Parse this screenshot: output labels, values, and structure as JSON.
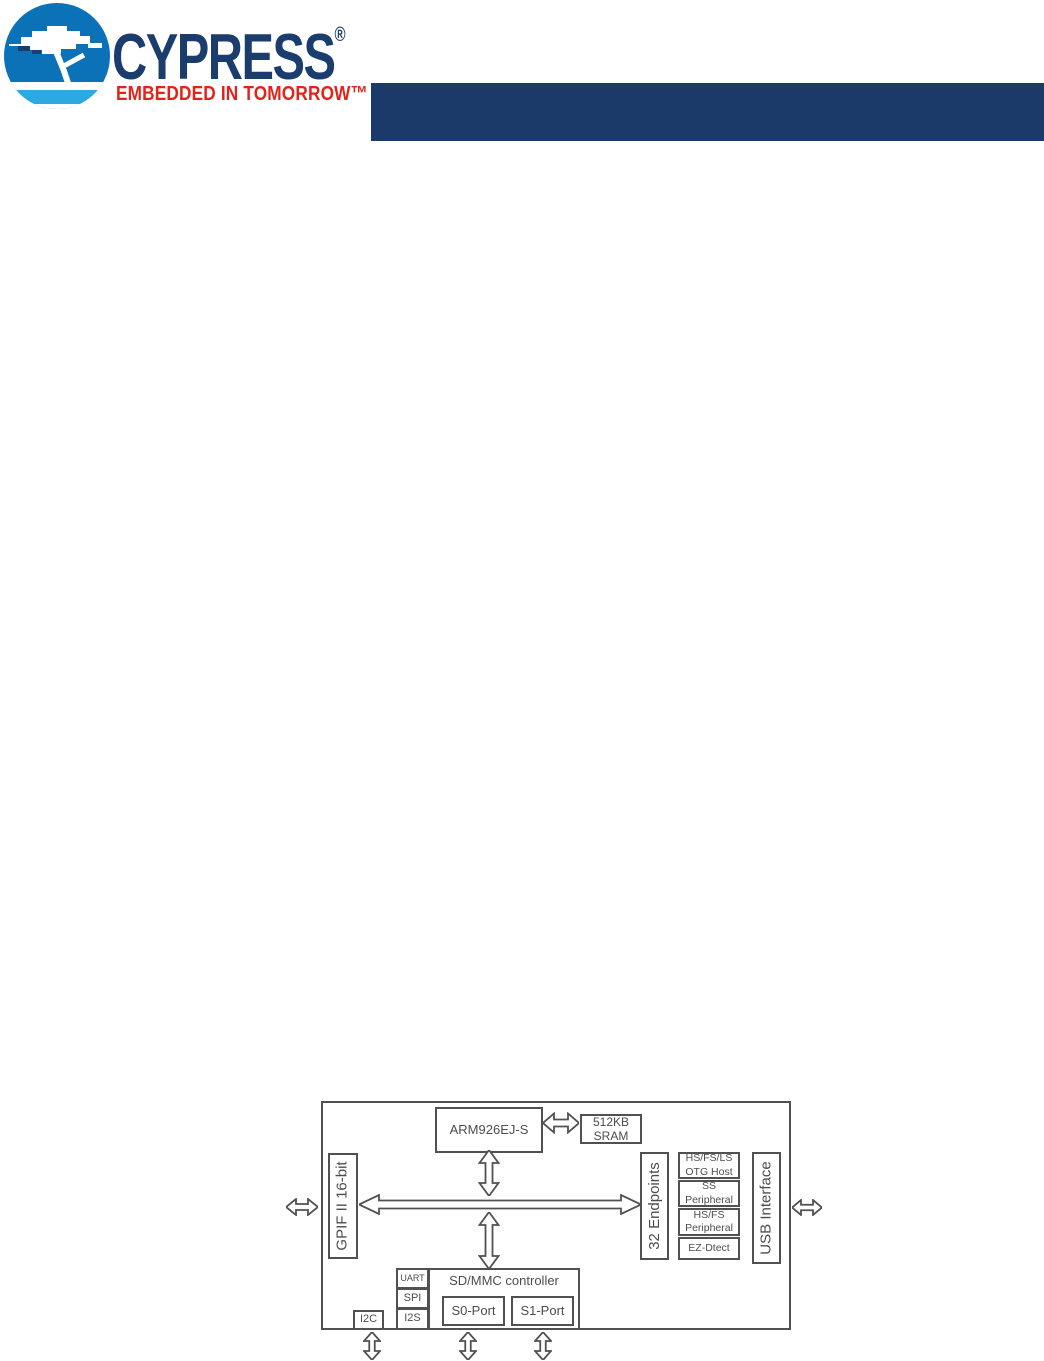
{
  "logo": {
    "brand": "CYPRESS",
    "registered_mark": "®",
    "tagline": "EMBEDDED IN TOMORROW™",
    "colors": {
      "circle_blue": "#0C72B8",
      "stripe_light_blue": "#2AAAE1",
      "brand_navy": "#1B3D6D",
      "tagline_red": "#E2231A"
    }
  },
  "header_bar": {
    "color": "#1C3A69"
  },
  "diagram": {
    "type": "block-diagram",
    "colors": {
      "line": "#515151",
      "text": "#4D4D4F"
    },
    "blocks": {
      "cpu": {
        "label": "ARM926EJ-S"
      },
      "sram": {
        "line1": "512KB",
        "line2": "SRAM"
      },
      "gpif": {
        "label": "GPIF II 16-bit"
      },
      "endpoints": {
        "label": "32 Endpoints"
      },
      "usb_stack": [
        {
          "line1": "HS/FS/LS",
          "line2": "OTG Host"
        },
        {
          "line1": "SS",
          "line2": "Peripheral"
        },
        {
          "line1": "HS/FS",
          "line2": "Peripheral"
        },
        {
          "line1": "EZ-Dtect",
          "line2": ""
        }
      ],
      "usb_interface": {
        "label": "USB Interface"
      },
      "uart": {
        "label": "UART"
      },
      "spi": {
        "label": "SPI"
      },
      "i2s": {
        "label": "I2S"
      },
      "i2c": {
        "label": "I2C"
      },
      "sdmmc": {
        "label": "SD/MMC controller"
      },
      "s0_port": {
        "label": "S0-Port"
      },
      "s1_port": {
        "label": "S1-Port"
      }
    }
  }
}
